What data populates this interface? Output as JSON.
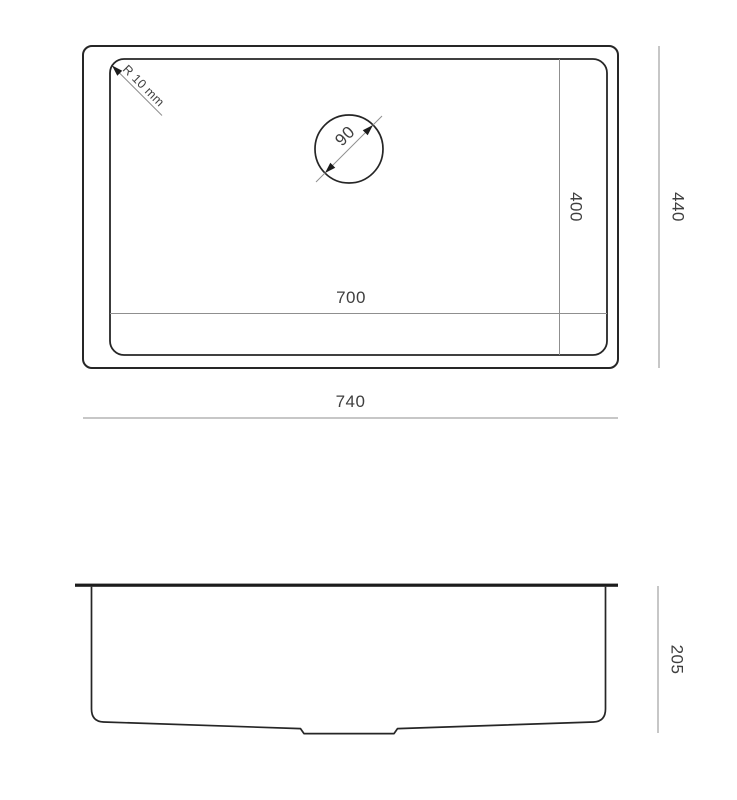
{
  "colors": {
    "background": "#ffffff",
    "outline": "#262626",
    "dimension_line": "#8f8f8f",
    "text": "#3f3f3f",
    "arrowhead": "#1c1c1c"
  },
  "top_view": {
    "outer_width_label": "740",
    "outer_depth_label": "440",
    "inner_width_label": "700",
    "inner_depth_label": "400",
    "drain_diameter_label": "90",
    "corner_radius_label": "R 10 mm"
  },
  "side_view": {
    "height_label": "205"
  }
}
